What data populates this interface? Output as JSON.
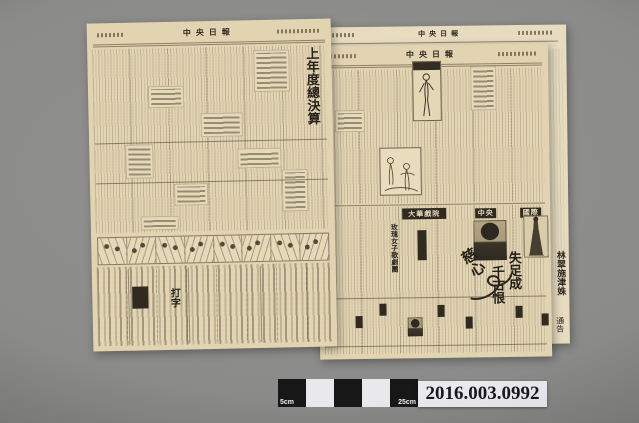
{
  "artifact": {
    "left_page": {
      "masthead": "中央日報",
      "headline": "上年度總決算",
      "ad_typing": "打字"
    },
    "right_page": {
      "masthead": "中央日報",
      "theater": "大華戲院",
      "troupe": "玫瑰女子歌劇團",
      "cinema_a": "中央",
      "cinema_b": "國際",
      "movie_title_part1": "失足成",
      "movie_title_part2": "千古恨",
      "movie_title_styled": "慈心",
      "classified_special": "特"
    },
    "under_page": {
      "masthead": "中央日報",
      "edge_names": "林翠施津姝",
      "edge_notice": "通告"
    }
  },
  "scale_bar": {
    "label_left": "5cm",
    "label_right": "25cm"
  },
  "catalog": {
    "number": "2016.003.0992"
  },
  "colors": {
    "background": "#8a8a88",
    "paper": "#e2d4b1",
    "ink": "#36302a"
  }
}
